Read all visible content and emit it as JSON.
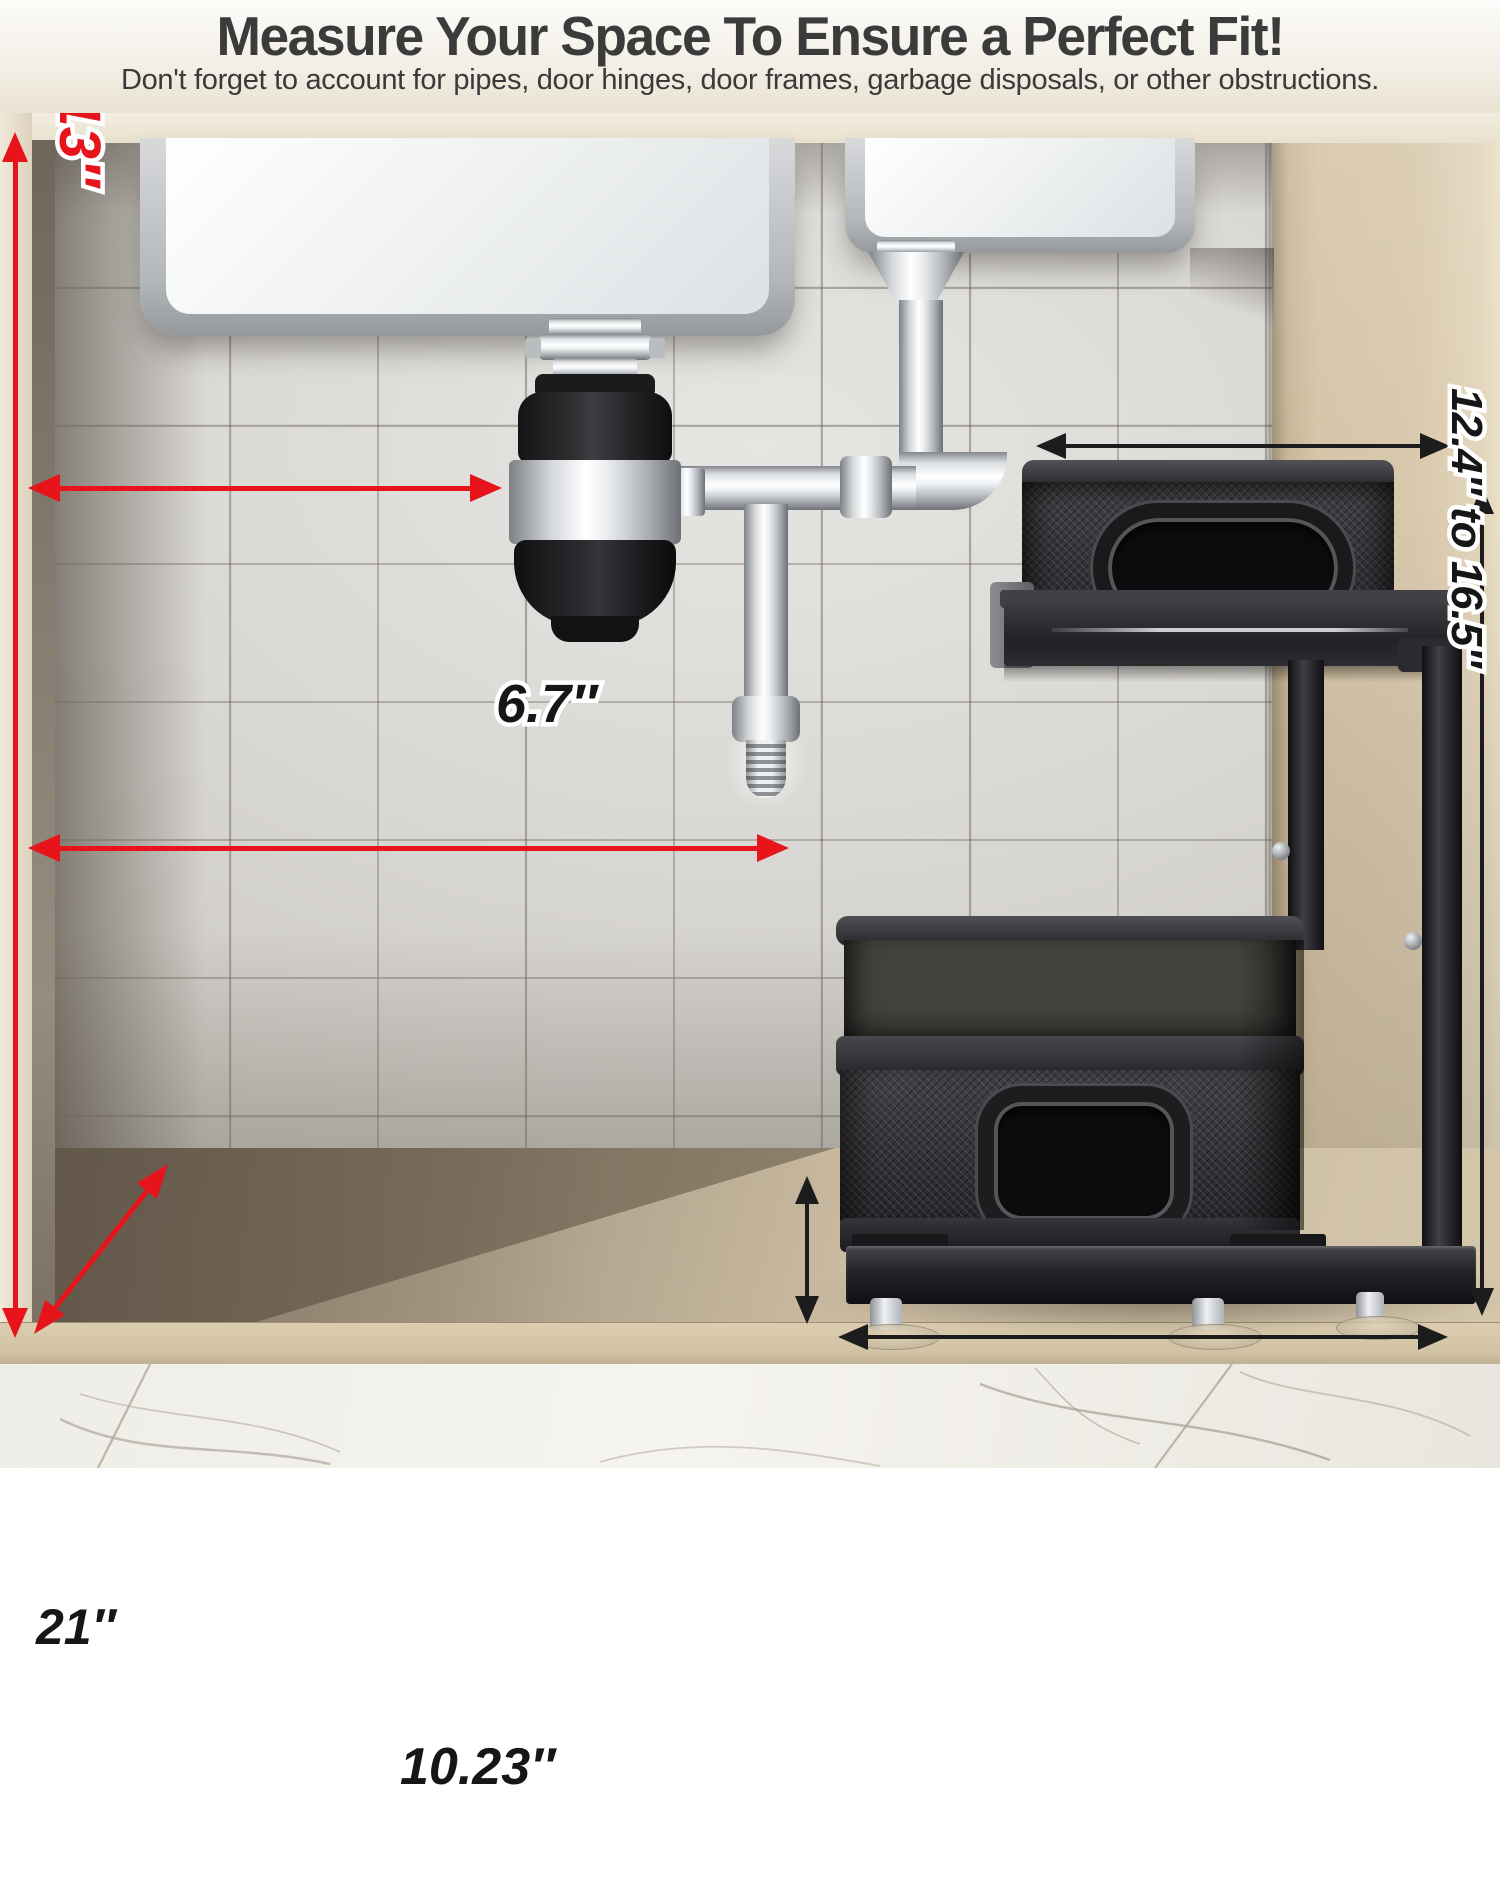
{
  "header": {
    "title": "Measure Your Space To Ensure a Perfect Fit!",
    "subtitle": "Don't forget to account for pipes, door hinges, door frames, garbage disposals, or other obstructions."
  },
  "annotations": {
    "w_top": "W≧8″",
    "h_left": "H≧13″",
    "w_mid": "W≧11″",
    "depth": "D≧22″",
    "basket_width": "6.7″",
    "height_range": "12.4″ to 16.5″",
    "basket_depth": "21″",
    "base_width": "10.23″"
  },
  "colors": {
    "measure_red": "#e8141c",
    "measure_black": "#1c1c1c",
    "label_outline": "#ffffff",
    "cabinet_beige": "#d5c4a7",
    "tile_gray": "#d8d6d2"
  }
}
